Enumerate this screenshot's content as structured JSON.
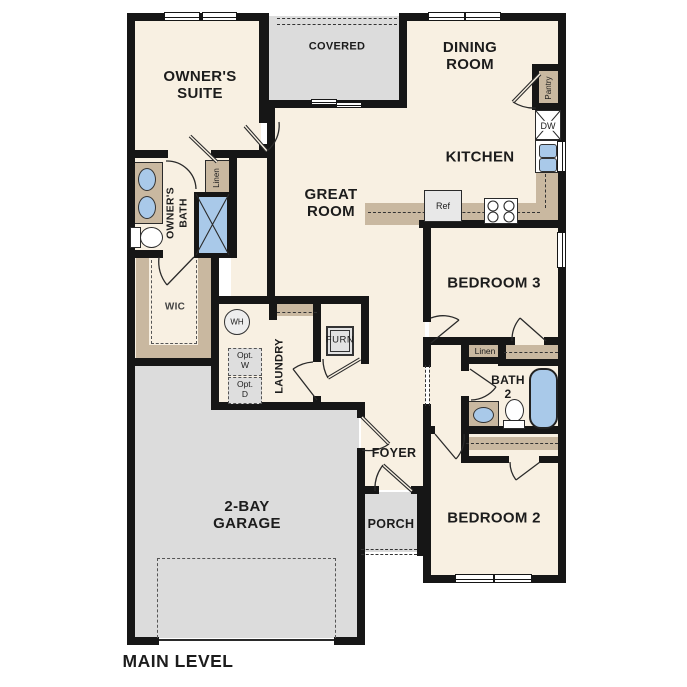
{
  "plan": {
    "level_label": "MAIN LEVEL",
    "rooms": {
      "owners_suite": "OWNER'S\nSUITE",
      "covered": "COVERED",
      "dining": "DINING\nROOM",
      "kitchen": "KITCHEN",
      "great_room": "GREAT\nROOM",
      "owners_bath": "OWNER'S\nBATH",
      "wic": "WIC",
      "laundry": "LAUNDRY",
      "bedroom3": "BEDROOM 3",
      "bath2": "BATH\n2",
      "foyer": "FOYER",
      "porch": "PORCH",
      "bedroom2": "BEDROOM 2",
      "garage": "2-BAY\nGARAGE"
    },
    "fixtures": {
      "pantry": "Pantry",
      "dw": "DW",
      "ref": "Ref",
      "linen_bath": "Linen",
      "linen_hall": "Linen",
      "wh": "WH",
      "opt_w": "Opt.\nW",
      "opt_d": "Opt.\nD",
      "furn": "FURN"
    },
    "colors": {
      "floor": "#f8f0e2",
      "exterior_space": "#dcdcdc",
      "casework": "#c9b8a0",
      "plumbing_fixture": "#a9c9e9",
      "wall": "#161616"
    }
  }
}
